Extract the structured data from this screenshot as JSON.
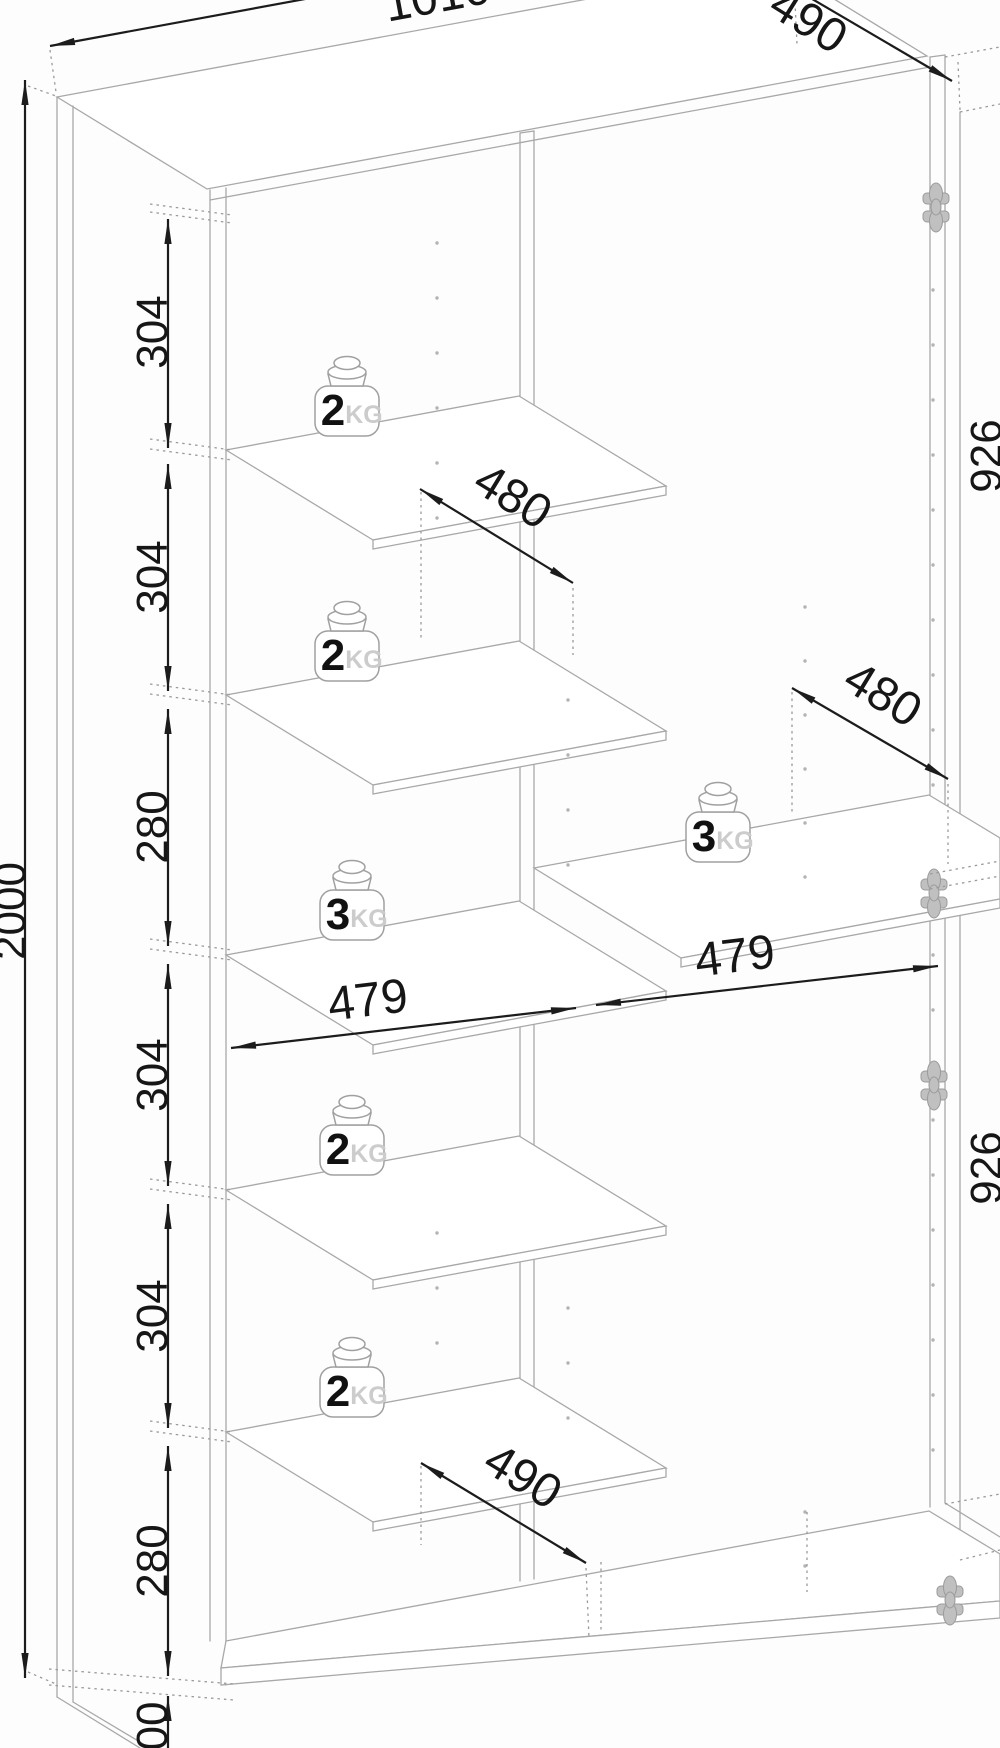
{
  "dimensions": {
    "overall_width": "1010",
    "overall_depth": "490",
    "overall_height": "2000",
    "left_sections": [
      "304",
      "304",
      "280",
      "304",
      "304",
      "280"
    ],
    "right_sections": [
      "926",
      "926"
    ],
    "inner_widths": [
      "479",
      "479"
    ],
    "shelf_depths": [
      "480",
      "480"
    ],
    "bottom_depth": "490",
    "plinth_height_partial": "00"
  },
  "weights": [
    {
      "num": "2",
      "unit": "KG"
    },
    {
      "num": "2",
      "unit": "KG"
    },
    {
      "num": "3",
      "unit": "KG"
    },
    {
      "num": "2",
      "unit": "KG"
    },
    {
      "num": "2",
      "unit": "KG"
    },
    {
      "num": "3",
      "unit": "KG"
    }
  ],
  "colors": {
    "dimension_line": "#1c1c1c",
    "cabinet_line": "#a8a8a8",
    "kg_text": "#cccccc",
    "hinge": "#c0c0c0"
  }
}
